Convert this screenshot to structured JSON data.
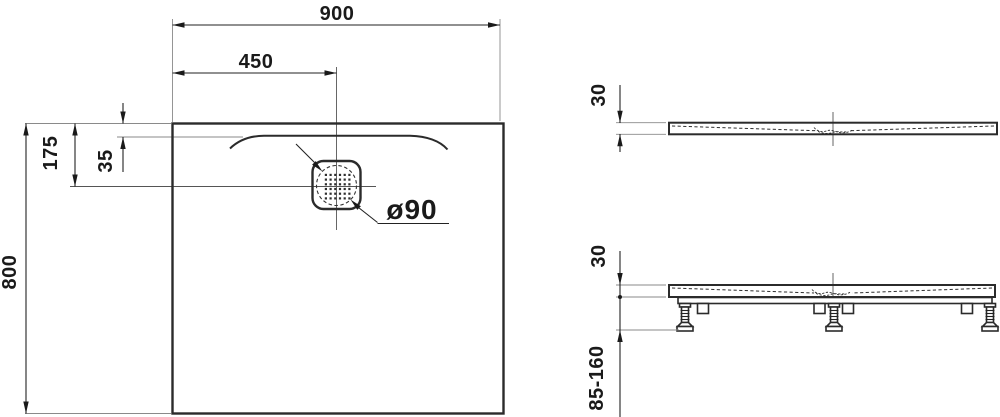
{
  "drawing": {
    "plan_view": {
      "width": "900",
      "drain_center_x": "450",
      "drain_offset_top": "175",
      "slope_edge_inset": "35",
      "depth": "800",
      "drain_diameter": "ø90"
    },
    "front_view": {
      "tray_height": "30"
    },
    "installation_view": {
      "tray_height": "30",
      "foot_height_range": "85-160"
    },
    "colors": {
      "line": "#2b2b2b",
      "dimension": "#1a1a1a",
      "extension_line": "#8a8a8a",
      "background": "#ffffff"
    }
  }
}
